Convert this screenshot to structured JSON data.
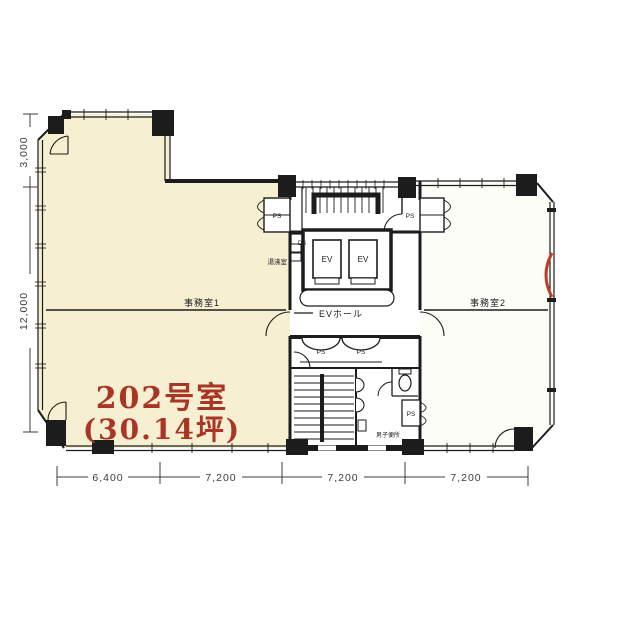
{
  "plan": {
    "unit": {
      "name": "202号室",
      "area": "(30.14坪)"
    },
    "rooms": {
      "office1": "事務室1",
      "office2": "事務室2",
      "ev_hall": "EVホール",
      "kitchenette": "湯沸室",
      "mens_toilet": "男子便所"
    },
    "shafts": {
      "elevator": "EV",
      "pipe": "PS",
      "duct": "DS"
    },
    "dimensions": {
      "left": [
        "3,000",
        "12,000"
      ],
      "bottom": [
        "6,400",
        "7,200",
        "7,200",
        "7,200"
      ]
    },
    "colors": {
      "room_fill": "#f6efd2",
      "accent_red": "#ab3524",
      "wall": "#1c1c1c",
      "dim_text": "#3c3c3c"
    }
  }
}
